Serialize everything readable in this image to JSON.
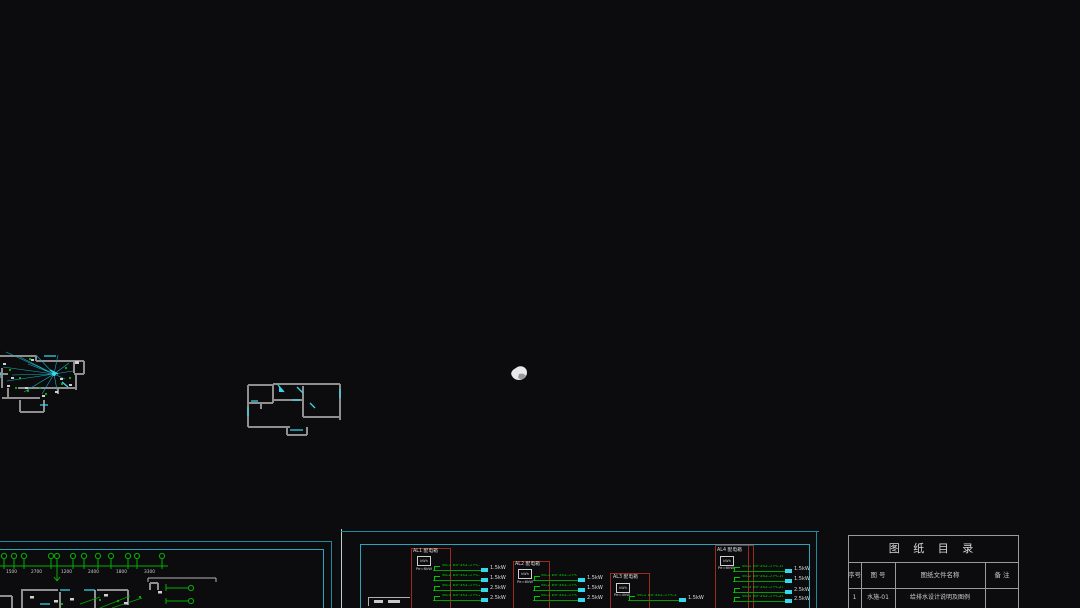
{
  "app": {
    "description": "CAD drawing canvas, electrical/plumbing construction drawings"
  },
  "colors": {
    "background": "#0c0c0e",
    "frame_cyan": "#1e8a9e",
    "bright_cyan": "#35d8e8",
    "entity_green": "#00b000",
    "wall_gray": "#8f8f8f",
    "box_red": "#9b2a20",
    "text_white": "#d8d8d8",
    "table_gray": "#9a9a9a"
  },
  "cursor": {
    "type": "pan-hand"
  },
  "drawings": {
    "wiring_plan_label": "lighting wiring floor plan (partially off-canvas)",
    "floor_plan_label": "apartment floor plan"
  },
  "left_sheet": {
    "axis_dims": [
      "1500",
      "2700",
      "1200",
      "2400",
      "1800",
      "3300"
    ]
  },
  "middle_sheet": {
    "boxes": [
      {
        "title": "AL1 配电箱",
        "meter": "kWh",
        "sub": "Pe=6kW",
        "circuits": [
          {
            "wire": "WL1 BV-3x2.5 PC16",
            "load": "1.5kW"
          },
          {
            "wire": "WL2 BV-3x2.5 PC16",
            "load": "1.5kW"
          },
          {
            "wire": "WL3 BV-3x2.5 PC20",
            "load": "2.5kW"
          },
          {
            "wire": "WL4 BV-3x2.5 PC20",
            "load": "2.5kW"
          }
        ]
      },
      {
        "title": "AL2 配电箱",
        "meter": "kWh",
        "sub": "Pe=6kW",
        "circuits": [
          {
            "wire": "WL1 BV-3x2.5 PC16",
            "load": "1.5kW"
          },
          {
            "wire": "WL2 BV-3x2.5 PC16",
            "load": "1.5kW"
          },
          {
            "wire": "WL3 BV-3x2.5 PC20",
            "load": "2.5kW"
          }
        ]
      },
      {
        "title": "AL3 配电箱",
        "meter": "kWh",
        "sub": "Pe=4kW",
        "circuits": [
          {
            "wire": "WL1 BV-3x2.5 PC16",
            "load": "1.5kW"
          }
        ]
      },
      {
        "title": "AL4 配电箱",
        "meter": "kWh",
        "sub": "Pe=6kW",
        "circuits": [
          {
            "wire": "WL1 BV-3x2.5 PC16",
            "load": "1.5kW"
          },
          {
            "wire": "WL2 BV-3x2.5 PC16",
            "load": "1.5kW"
          },
          {
            "wire": "WL3 BV-3x2.5 PC20",
            "load": "2.5kW"
          },
          {
            "wire": "WL4 BV-3x2.5 PC20",
            "load": "2.5kW"
          }
        ]
      }
    ]
  },
  "catalog": {
    "title": "图 纸 目 录",
    "headers": [
      "序号",
      "图 号",
      "图纸文件名称",
      "备 注"
    ],
    "rows": [
      {
        "no": "1",
        "code": "水施-01",
        "name": "给排水设计说明及图例",
        "note": ""
      }
    ]
  }
}
